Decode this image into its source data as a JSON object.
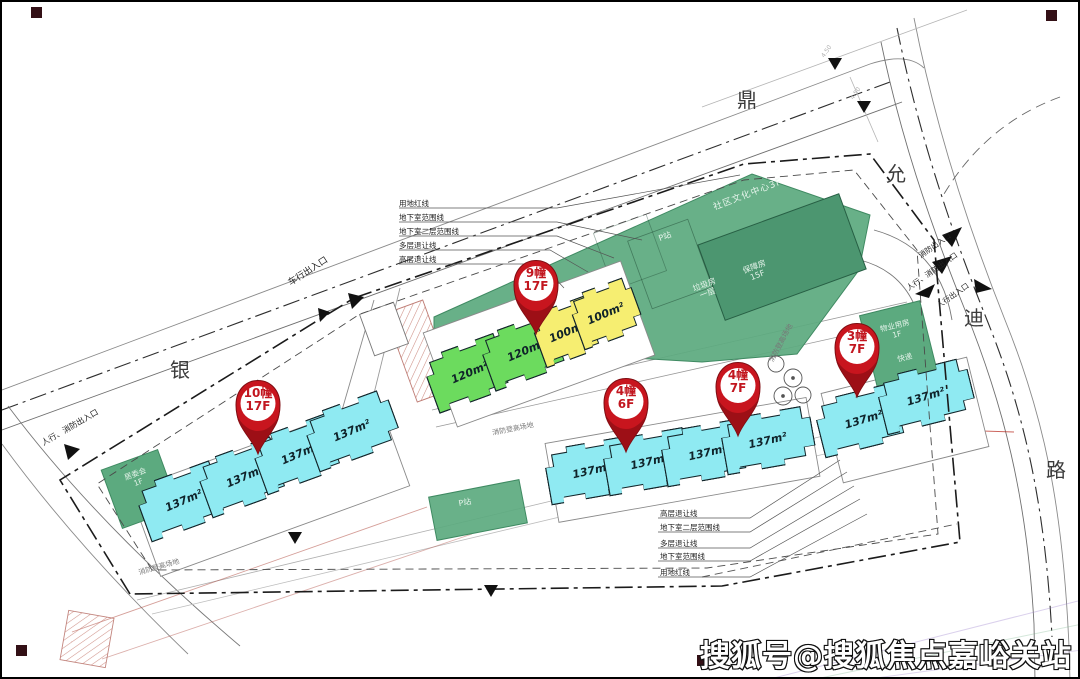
{
  "watermark": "搜狐号@搜狐焦点嘉峪关站",
  "road_names": {
    "west": "银",
    "north": "鼎",
    "northeast": "允",
    "east": "迪",
    "southeast": "路"
  },
  "pins": [
    {
      "name": "10幢",
      "floors": "17F"
    },
    {
      "name": "9幢",
      "floors": "17F"
    },
    {
      "name": "4幢",
      "floors": "6F"
    },
    {
      "name": "4幢",
      "floors": "7F"
    },
    {
      "name": "3幢",
      "floors": "7F"
    }
  ],
  "unit_areas": {
    "cyan": "137m²",
    "green": "120m²",
    "yellow": "100m²"
  },
  "facilities": {
    "community_center": "社区文化中心3F",
    "support_housing_name": "保障房",
    "support_housing_floor": "15F",
    "p_station": "P站",
    "garbage_name": "垃圾房",
    "garbage_floor": "一层",
    "property_name": "物业用房",
    "property_floor": "1F",
    "express": "快递",
    "committee_name": "居委会",
    "committee_floor": "1F"
  },
  "entrances": {
    "vehicle": "车行出入口",
    "pedestrian_fire_west": "人行、消防出入口",
    "fire_ne": "消防出入口",
    "pedestrian_fire_ne": "人行、消防出入口",
    "pedestrian_ne": "人行出入口"
  },
  "boundary_labels": {
    "top": [
      "用地红线",
      "地下室范围线",
      "地下室二层范围线",
      "多层退让线",
      "高层退让线"
    ],
    "bottom": [
      "高层退让线",
      "地下室二层范围线",
      "多层退让线",
      "地下室范围线",
      "用地红线"
    ]
  },
  "fire_lane_label": "消防登高场地",
  "dimensions": [
    "4.50",
    "4.50"
  ]
}
